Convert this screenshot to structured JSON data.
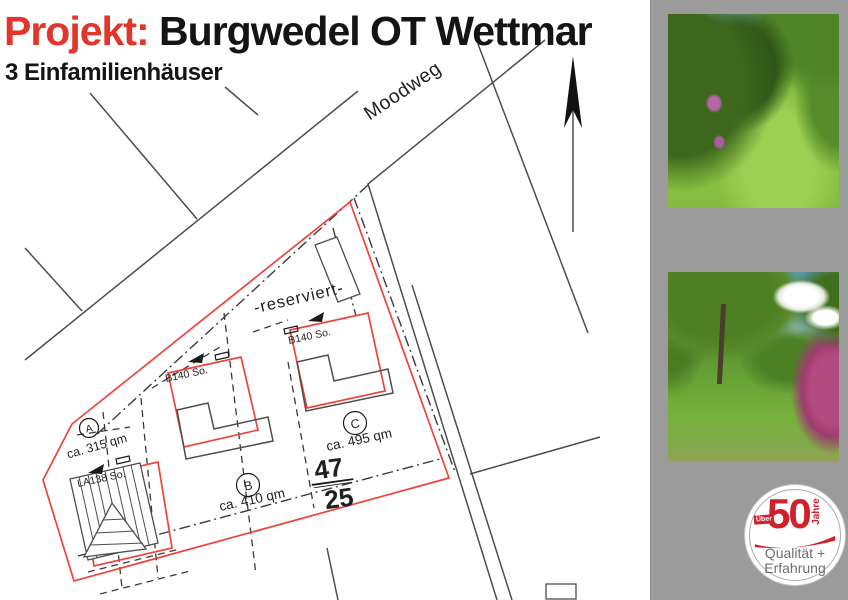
{
  "header": {
    "project_label": "Projekt:",
    "project_name": " Burgwedel OT Wettmar",
    "subtitle": "3 Einfamilienhäuser"
  },
  "plan": {
    "street": "Moodweg",
    "reserved": "-reserviert-",
    "parcel": {
      "numerator": "47",
      "denominator": "25"
    },
    "plots": [
      {
        "letter": "A",
        "area": "ca. 315 qm",
        "code": "LA138 So."
      },
      {
        "letter": "B",
        "area": "ca. 410 qm",
        "code": "B140 So."
      },
      {
        "letter": "C",
        "area": "ca. 495 qm",
        "code": "B140 So."
      }
    ]
  },
  "sidebar": {
    "photo1_name": "garden-path-photo",
    "photo2_name": "meadow-tree-photo",
    "badge": {
      "ueber": "Über",
      "number": "50",
      "jahre": "Jahre",
      "line1": "Qualität +",
      "line2": "Erfahrung"
    }
  },
  "colors": {
    "accent_red": "#e0362b",
    "plan_red": "#ee4339",
    "line_gray": "#4d4d4d",
    "panel_gray": "#9b9b9b",
    "badge_red": "#d0202c"
  }
}
